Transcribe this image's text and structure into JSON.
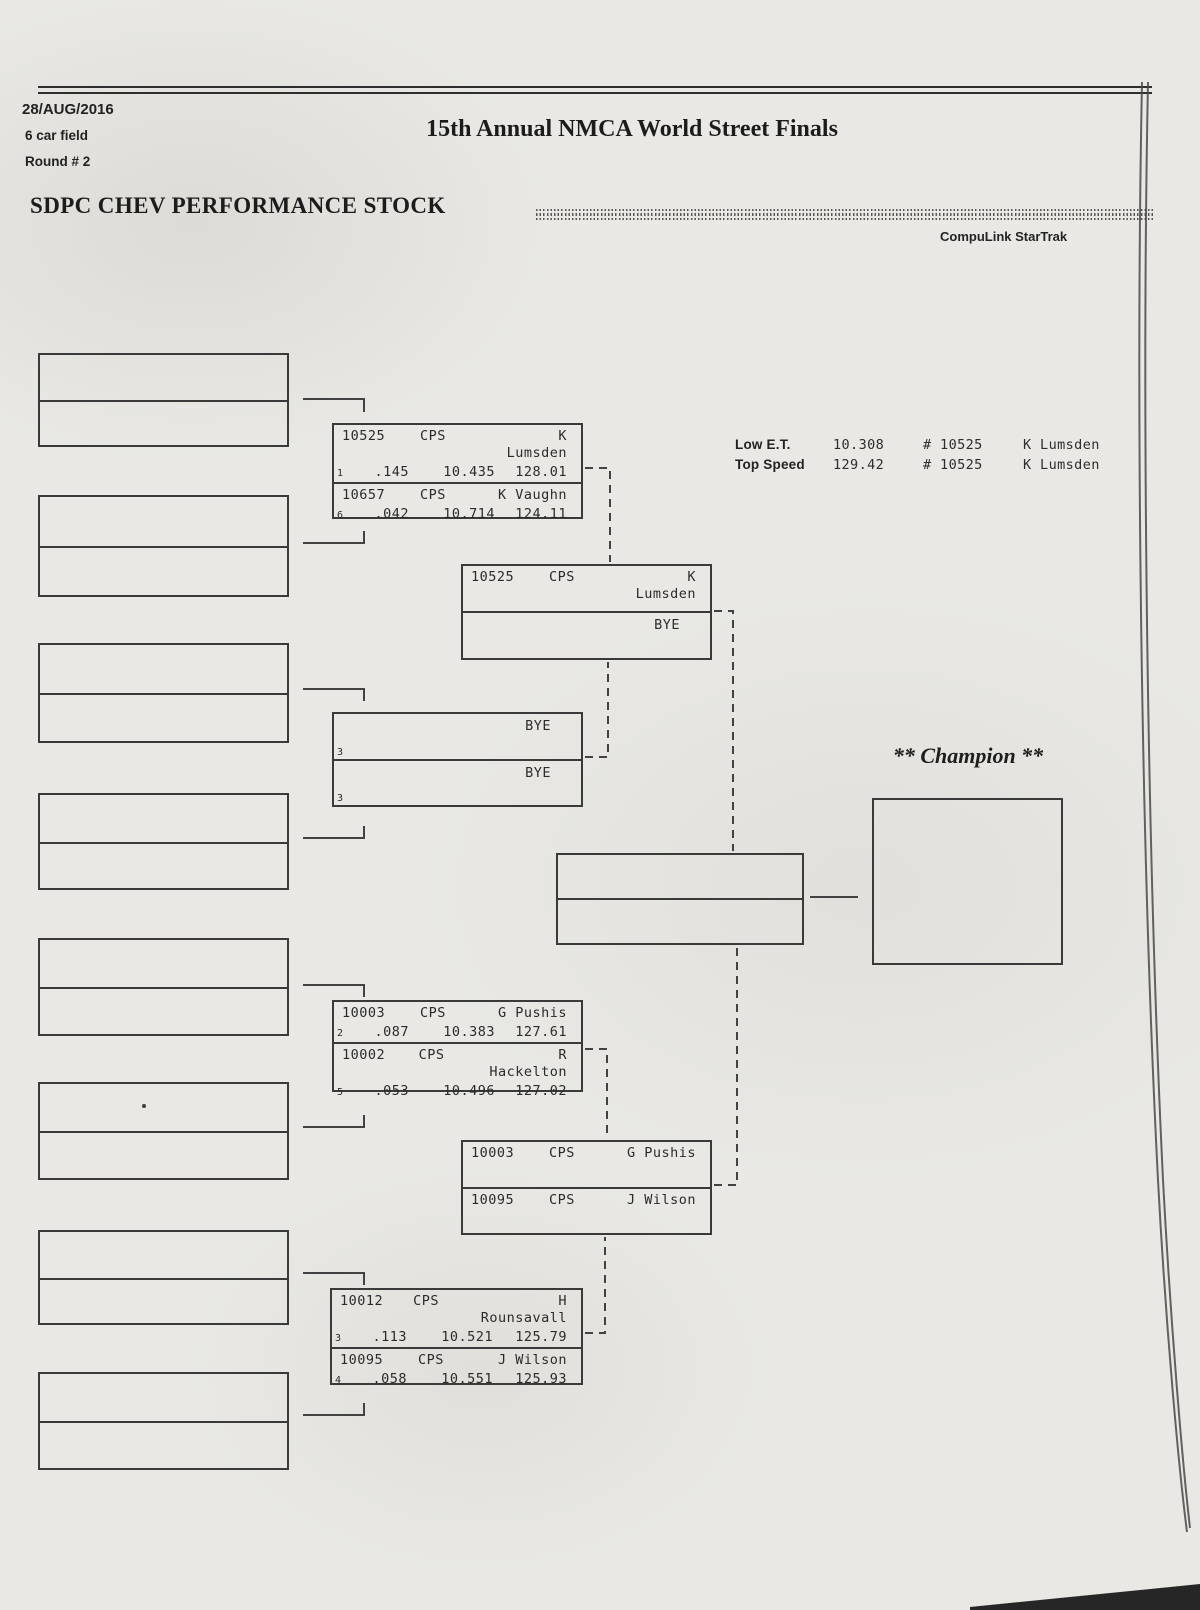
{
  "page": {
    "date": "28/AUG/2016",
    "field_size": "6 car field",
    "round": "Round # 2",
    "event_title": "15th Annual NMCA World Street Finals",
    "class_title": "SDPC CHEV PERFORMANCE STOCK",
    "brand": "CompuLink StarTrak",
    "champion_label": "** Champion **"
  },
  "stats": {
    "low_et": {
      "label": "Low  E.T.",
      "value": "10.308",
      "car": "# 10525",
      "driver": "K Lumsden"
    },
    "top_speed": {
      "label": "Top Speed",
      "value": "129.42",
      "car": "# 10525",
      "driver": "K Lumsden"
    }
  },
  "bracket": {
    "round1": [
      {
        "entries": [
          {
            "car": "10525",
            "cls": "CPS",
            "driver": "K Lumsden",
            "lane": "1",
            "reaction": ".145",
            "et": "10.435",
            "speed": "128.01"
          },
          {
            "car": "10657",
            "cls": "CPS",
            "driver": "K Vaughn",
            "lane": "6",
            "reaction": ".042",
            "et": "10.714",
            "speed": "124.11"
          }
        ]
      },
      {
        "entries": [
          {
            "driver": "BYE",
            "lane": "3"
          },
          {
            "driver": "BYE",
            "lane": "3"
          }
        ]
      },
      {
        "entries": [
          {
            "car": "10003",
            "cls": "CPS",
            "driver": "G Pushis",
            "lane": "2",
            "reaction": ".087",
            "et": "10.383",
            "speed": "127.61"
          },
          {
            "car": "10002",
            "cls": "CPS",
            "driver": "R Hackelton",
            "lane": "5",
            "reaction": ".053",
            "et": "10.496",
            "speed": "127.02"
          }
        ]
      },
      {
        "entries": [
          {
            "car": "10012",
            "cls": "CPS",
            "driver": "H Rounsavall",
            "lane": "3",
            "reaction": ".113",
            "et": "10.521",
            "speed": "125.79"
          },
          {
            "car": "10095",
            "cls": "CPS",
            "driver": "J Wilson",
            "lane": "4",
            "reaction": ".058",
            "et": "10.551",
            "speed": "125.93"
          }
        ]
      }
    ],
    "semifinals": [
      {
        "entries": [
          {
            "car": "10525",
            "cls": "CPS",
            "driver": "K Lumsden"
          },
          {
            "driver": "BYE"
          }
        ]
      },
      {
        "entries": [
          {
            "car": "10003",
            "cls": "CPS",
            "driver": "G Pushis"
          },
          {
            "car": "10095",
            "cls": "CPS",
            "driver": "J Wilson"
          }
        ]
      }
    ]
  }
}
